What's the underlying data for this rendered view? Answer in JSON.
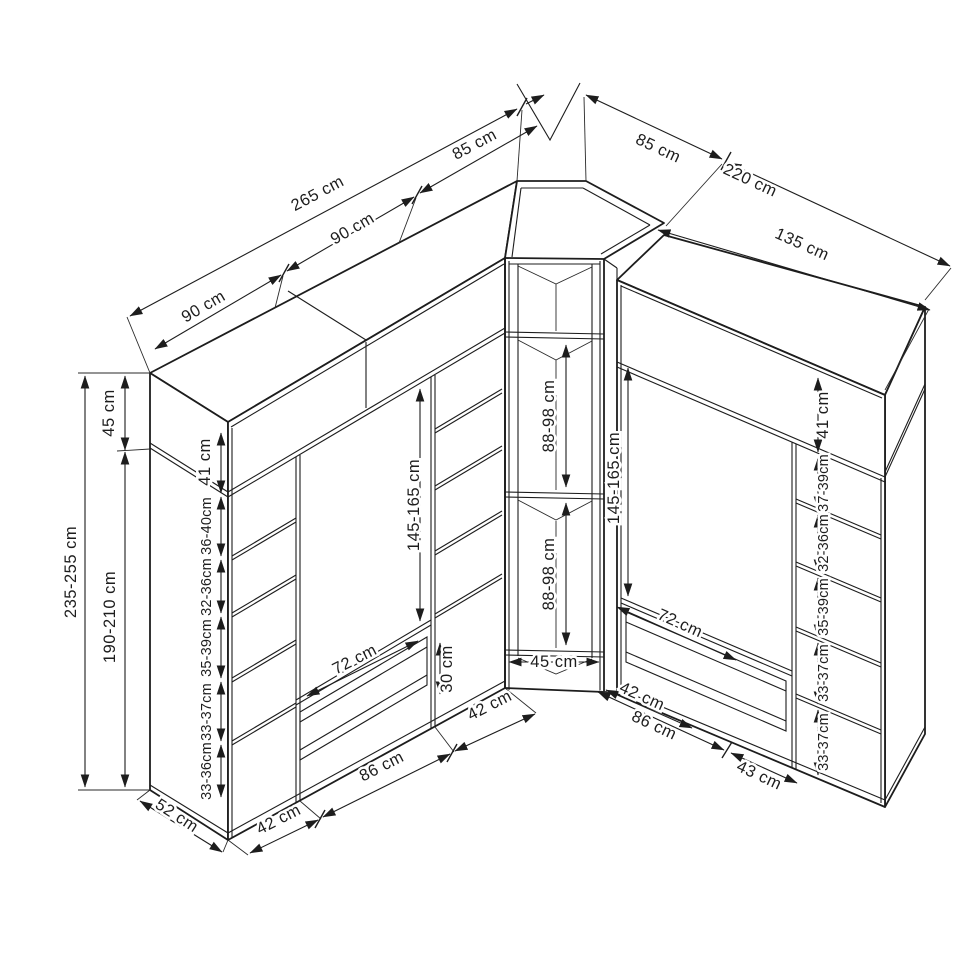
{
  "figure": {
    "kind": "isometric dimension drawing",
    "subject": "corner wardrobe interior layout",
    "unit": "cm",
    "line_color": "#1d1d1d",
    "background": "#ffffff"
  },
  "dimensions": {
    "top": {
      "left_total": "265 cm",
      "left_section_a": "90 cm",
      "left_section_b": "90 cm",
      "corner_left": "85 cm",
      "corner_right": "85 cm",
      "right_total": "220 cm",
      "right_section": "135 cm"
    },
    "left_side": {
      "height_total": "235-255 cm",
      "interior_height": "190-210 cm",
      "top_shelf": "45 cm",
      "top_shelf_interior": "41 cm",
      "shelf_gaps": [
        "36-40cm",
        "32-36cm",
        "35-39cm",
        "33-37cm",
        "33-36cm"
      ]
    },
    "right_side": {
      "top_shelf_interior": "41 cm",
      "shelf_gaps": [
        "37-39cm",
        "32-36cm",
        "35-39cm",
        "33-37cm",
        "33-37cm"
      ]
    },
    "center": {
      "corner_upper": "88-98 cm",
      "corner_lower": "88-98 cm",
      "hanging_left": "145-165 cm",
      "hanging_right": "145-165 cm",
      "corner_opening": "45 cm",
      "drawer_zone": "30 cm"
    },
    "bench": {
      "left": "72 cm",
      "right": "72 cm"
    },
    "bottom": {
      "depth": "52 cm",
      "left_outer_column": "42 cm",
      "left_bay": "86 cm",
      "left_inner_column": "42 cm",
      "corner_return": "42 cm",
      "right_bay": "86 cm",
      "right_column": "43 cm"
    }
  }
}
